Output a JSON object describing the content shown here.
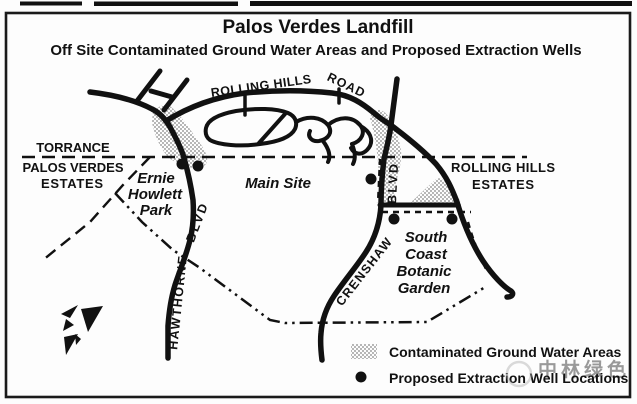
{
  "title": "Palos Verdes Landfill",
  "subtitle": "Off Site Contaminated Ground Water Areas and Proposed Extraction Wells",
  "regions": {
    "torrance": "TORRANCE",
    "palos_verdes_estates": {
      "line1": "PALOS VERDES",
      "line2": "ESTATES"
    },
    "rolling_hills_estates": {
      "line1": "ROLLING HILLS",
      "line2": "ESTATES"
    },
    "main_site": "Main Site",
    "ernie_howlett_park": {
      "line1": "Ernie",
      "line2": "Howlett",
      "line3": "Park"
    },
    "south_coast_botanic_garden": {
      "line1": "South",
      "line2": "Coast",
      "line3": "Botanic",
      "line4": "Garden"
    }
  },
  "roads": {
    "rolling_hills": "ROLLING HILLS",
    "road": "ROAD",
    "hawthorne": "HAWTHORNE",
    "hawthorne_blvd": "BLVD",
    "crenshaw": "CRENSHAW",
    "crenshaw_blvd": "BLVD"
  },
  "legend": {
    "contaminated_label": "Contaminated Ground Water Areas",
    "wells_label": "Proposed Extraction Well Locations"
  },
  "map": {
    "wells": [
      {
        "x": 182,
        "y": 164
      },
      {
        "x": 198,
        "y": 166
      },
      {
        "x": 371,
        "y": 179
      },
      {
        "x": 394,
        "y": 219
      },
      {
        "x": 452,
        "y": 219
      }
    ]
  },
  "watermark": {
    "text": "中林绿色"
  },
  "colors": {
    "ink": "#111111",
    "stipple": "#9a9a9a",
    "background": "#fdfdfd",
    "watermark": "#a8a8a8"
  }
}
